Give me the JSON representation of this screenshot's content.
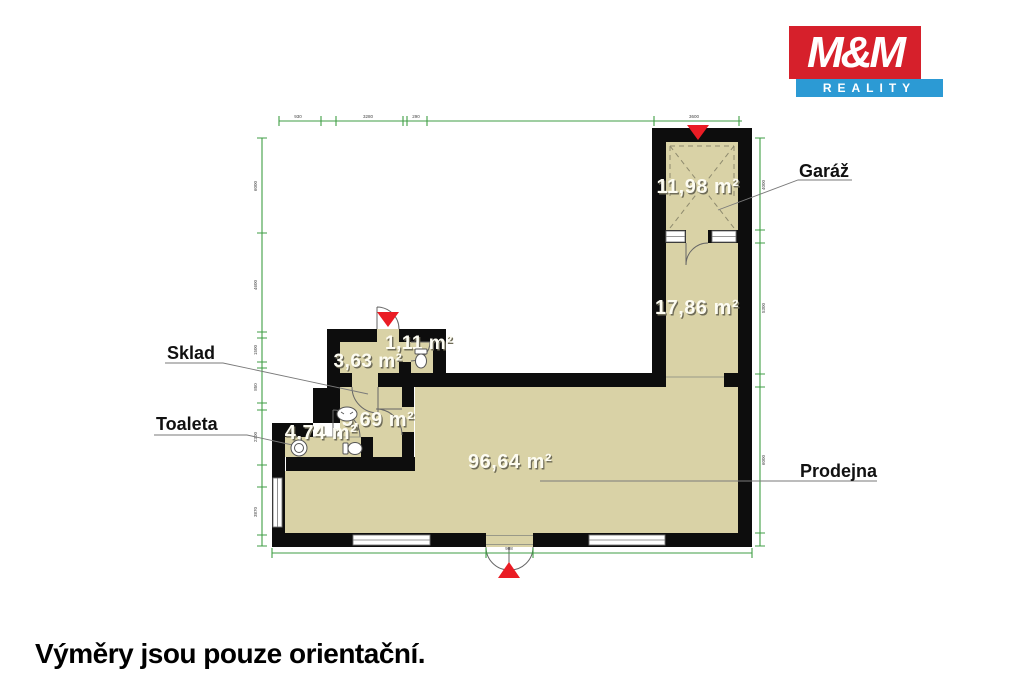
{
  "logo": {
    "top": "M&M",
    "bottom": "REALITY",
    "red": "#d6202b",
    "blue": "#2c9ad4"
  },
  "footer_note": "Výměry jsou pouze orientační.",
  "plan": {
    "labels": {
      "garage": "Garáž",
      "storage": "Sklad",
      "toilet": "Toaleta",
      "shop": "Prodejna"
    },
    "areas": {
      "garage": "11,98 m²",
      "backroom": "17,86 m²",
      "storage": "3,63 m²",
      "wc": "1,11 m²",
      "hallway": "5,69 m²",
      "toilet": "4,74 m²",
      "shop": "96,64 m²"
    },
    "dims": {
      "top": [
        "930",
        "3280",
        "290",
        "3600"
      ],
      "left": [
        "6000",
        "4600",
        "1500",
        "850",
        "2300",
        "3870"
      ],
      "right": [
        "4000",
        "5300",
        "6000"
      ],
      "bottom": [
        "908"
      ]
    },
    "colors": {
      "room_fill": "#d9d2a6",
      "wall": "#0d0d0d",
      "dimension_line": "#3f9e44",
      "entrance_marker": "#ea1c24",
      "leader_line": "#7a7a7a"
    }
  }
}
